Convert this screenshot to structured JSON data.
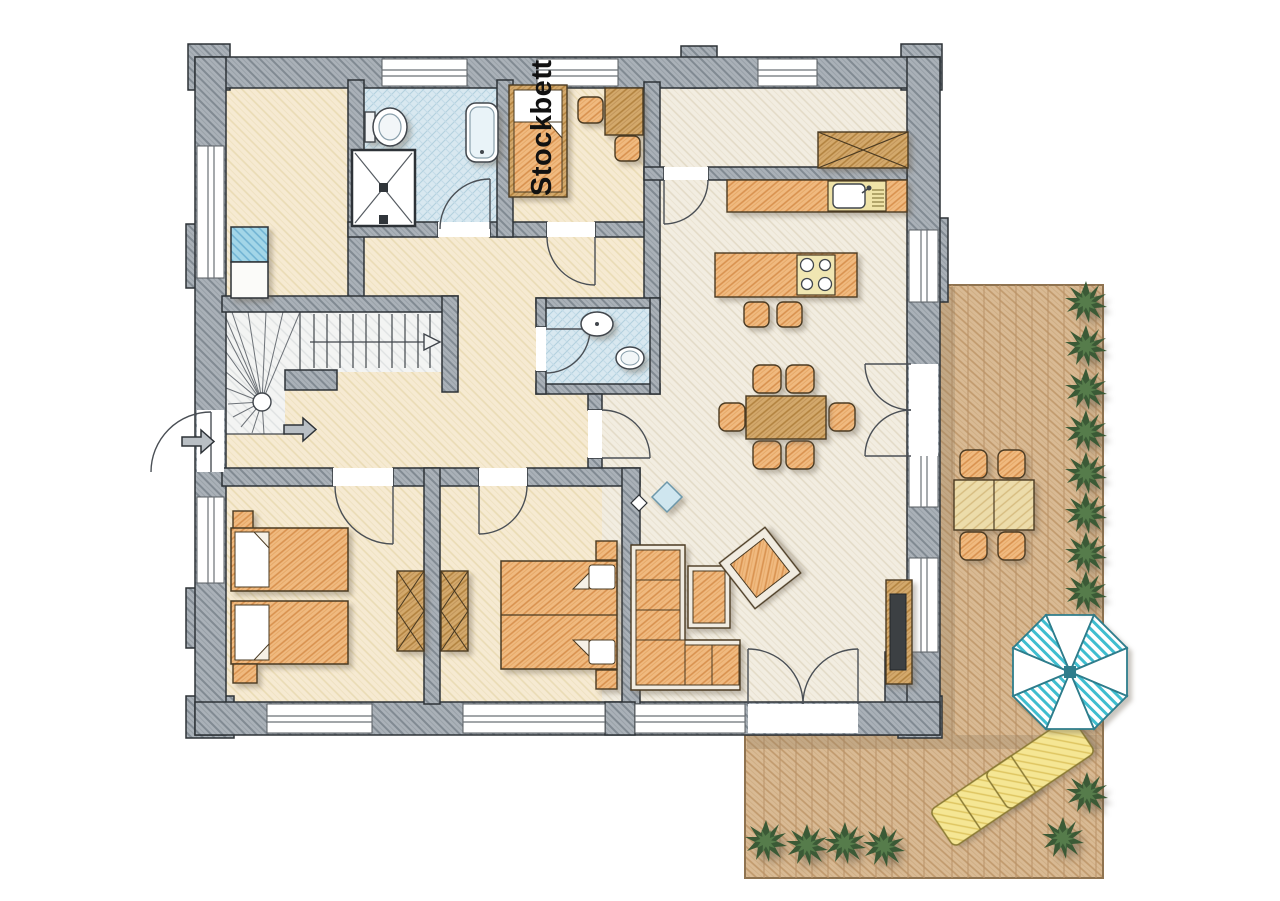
{
  "plan": {
    "labels": {
      "bunk_bed": "Stockbett"
    },
    "colors": {
      "wall_fill": "#aab1b8",
      "wall_outline": "#2d3237",
      "floor": "#f6ead2",
      "floor_living": "#f2ede1",
      "tile_blue": "#d8e8f0",
      "wood_orange": "#f0ba80",
      "wood_dark": "#d3a96c",
      "deck_tan": "#d9ba94",
      "lounger_yellow": "#f5e694",
      "appliance_blue": "#a3d6e8",
      "umbrella_teal": "#3fbdcf",
      "plant_green": "#3b5a36"
    },
    "rooms": [
      "storage",
      "bathroom",
      "shower",
      "bunk-bedroom",
      "hallway",
      "entry",
      "stairs",
      "wc",
      "kitchen",
      "living-dining-room",
      "bedroom-1",
      "bedroom-2",
      "terrace-deck"
    ],
    "furniture": [
      "washing-machine",
      "dryer",
      "toilet",
      "bathtub",
      "shower-cabin",
      "bunk-bed",
      "desk-with-chairs",
      "wardrobe-cabinet",
      "kitchen-counter-with-sink",
      "kitchen-island-with-stove",
      "bar-stools",
      "dining-table-with-6-chairs",
      "wc-sink",
      "wc-toilet",
      "two-single-beds",
      "double-bed",
      "corner-sofa",
      "coffee-table",
      "armchair",
      "tv-sideboard",
      "outdoor-dining-set",
      "parasol",
      "sun-loungers",
      "shrubs"
    ]
  }
}
